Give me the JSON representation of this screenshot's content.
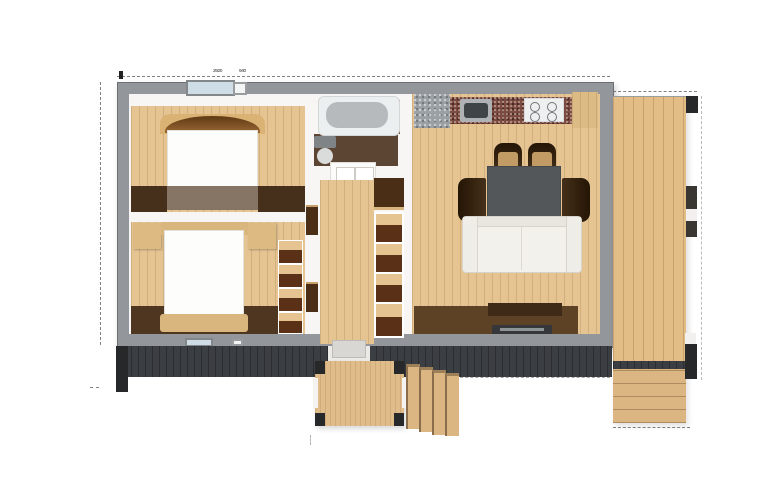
{
  "scene": {
    "type": "architectural-floor-plan",
    "description": "Top-down 3D render of a small rectangular cabin: two bedrooms on the left, central bathroom and hallway with closets, open kitchen-dining-living room on the right, full-height side deck with steps, dark front facade strip and front entry porch with fan steps",
    "rooms": [
      "bedroom-1",
      "bedroom-2",
      "bathroom",
      "hallway",
      "kitchen-living-room",
      "deck",
      "entry-porch"
    ]
  },
  "annotations": {
    "dim_label_1": "2920",
    "dim_label_2": "940"
  },
  "palette": {
    "background": "#ffffff",
    "wall": "#93969a",
    "wall-edge": "#6d7073",
    "interior": "#f7f6f4",
    "wood": "#e5c492",
    "wood-deck": "#e2bd86",
    "wood-step": "#dcb682",
    "dark-wood": "#47301b",
    "band-brown": "#5e4226",
    "band-gray-brown": "#867565",
    "bath-floor": "#5d4533",
    "facade": "#3b3e42",
    "post": "#26282a",
    "glass": "#cfdde6",
    "granite": "#7b4a40",
    "counter-gray": "#9aa0a4",
    "table": "#54575a",
    "chair-seat": "#c29a63",
    "sofa": "#f3f1ec",
    "bed": "#fdfdfc",
    "headboard": "#8a572a",
    "tv": "#35373a"
  }
}
